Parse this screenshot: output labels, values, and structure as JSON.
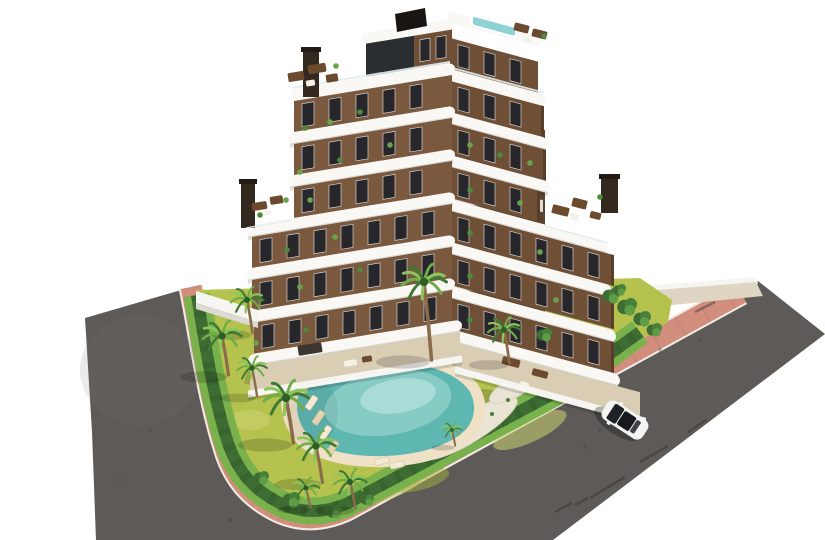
{
  "scene": {
    "description": "Aerial 3D architectural rendering of a modern six-storey white and brown apartment building with rooftop terraces and a plunge pool, a landscaped garden with palm trees and a freeform sandy-edged turquoise swimming pool with sun loungers, wrapped by a curving grey asphalt road with pink pavements and one white car driving on the road",
    "background_color": "#ffffff"
  },
  "road": {
    "label": "asphalt road",
    "color": "#5d5a57",
    "marking_color": "#37342f",
    "light_patch_color": "#7a7672"
  },
  "sidewalk": {
    "label": "pink pavement",
    "color": "#d28e7d",
    "speckle_color": "#c07f6e",
    "curb_color": "#f3ece6"
  },
  "walkway": {
    "label": "entrance walkway",
    "color": "#ded5c2",
    "wall_color": "#f6f5f2"
  },
  "garden": {
    "label": "landscaped garden",
    "lawn_color": "#b6c24e",
    "lawn_light": "#ccd572",
    "lawn_dark": "#a3b23f",
    "grass_strip_color": "#79b14c",
    "grass_strip_dark": "#6aa344",
    "hedge_color": "#3e6d33",
    "hedge_dark": "#335d2b",
    "gravel_color": "#e9e4d4",
    "gravel_edge": "#d8d2c0",
    "bush_color": "#46803a",
    "bush_light": "#5f9c46",
    "shadow_color": "#2e3a1e"
  },
  "pool": {
    "label": "freeform swimming pool",
    "sand_color": "#eee1c6",
    "water_deep": "#5fb7b2",
    "water_light": "#a8dcd6",
    "edge_highlight": "#cdeeea",
    "lounger_colors": [
      "#f3ead6",
      "#e3d3ae"
    ],
    "pole_color": "#33312e"
  },
  "building": {
    "label": "apartment building",
    "slab_color": "#f9f8f5",
    "slab_edge_color": "#d9d7d2",
    "railing_color": "#e3edef",
    "left_wall_color": "#7a593e",
    "right_wall_color": "#6f5037",
    "wall_edge_dark": "#583d29",
    "courtyard_color": "#5a432f",
    "courtyard_band": "#efeeea",
    "penthouse_glass_color": "#2b2e31",
    "window_color": "#26262b",
    "window_frame_color": "#e8e8e8",
    "patio_color": "#d9cdb4",
    "parapet_color": "#f6f5f2",
    "chimney_color": "#34291f",
    "chimney_cap": "#231a15",
    "roof_box_color": "#181512",
    "rooftop_pool_color": "#8fd2d6",
    "furniture_wood": "#6b4a2e",
    "furniture_white": "#f4f1e8",
    "pergola_color": "#3c3530",
    "floors": 6
  },
  "vegetation": {
    "palm_trunk": "#8a6b4a",
    "palm_fronds": [
      "#3f7a35",
      "#6fae47",
      "#8cc65a"
    ],
    "palm_core": "#2e5d27",
    "palm_count": 12,
    "balcony_plant_colors": [
      "#4e8a3c",
      "#6aa34e"
    ]
  },
  "car": {
    "label": "white car",
    "body_color": "#f3f3f1",
    "body_edge": "#d9d9d6",
    "glass_color": "#1f2227",
    "roof_glass": "#17191d",
    "rear_glass": "#2a2d33",
    "shadow_opacity": 0.28
  }
}
